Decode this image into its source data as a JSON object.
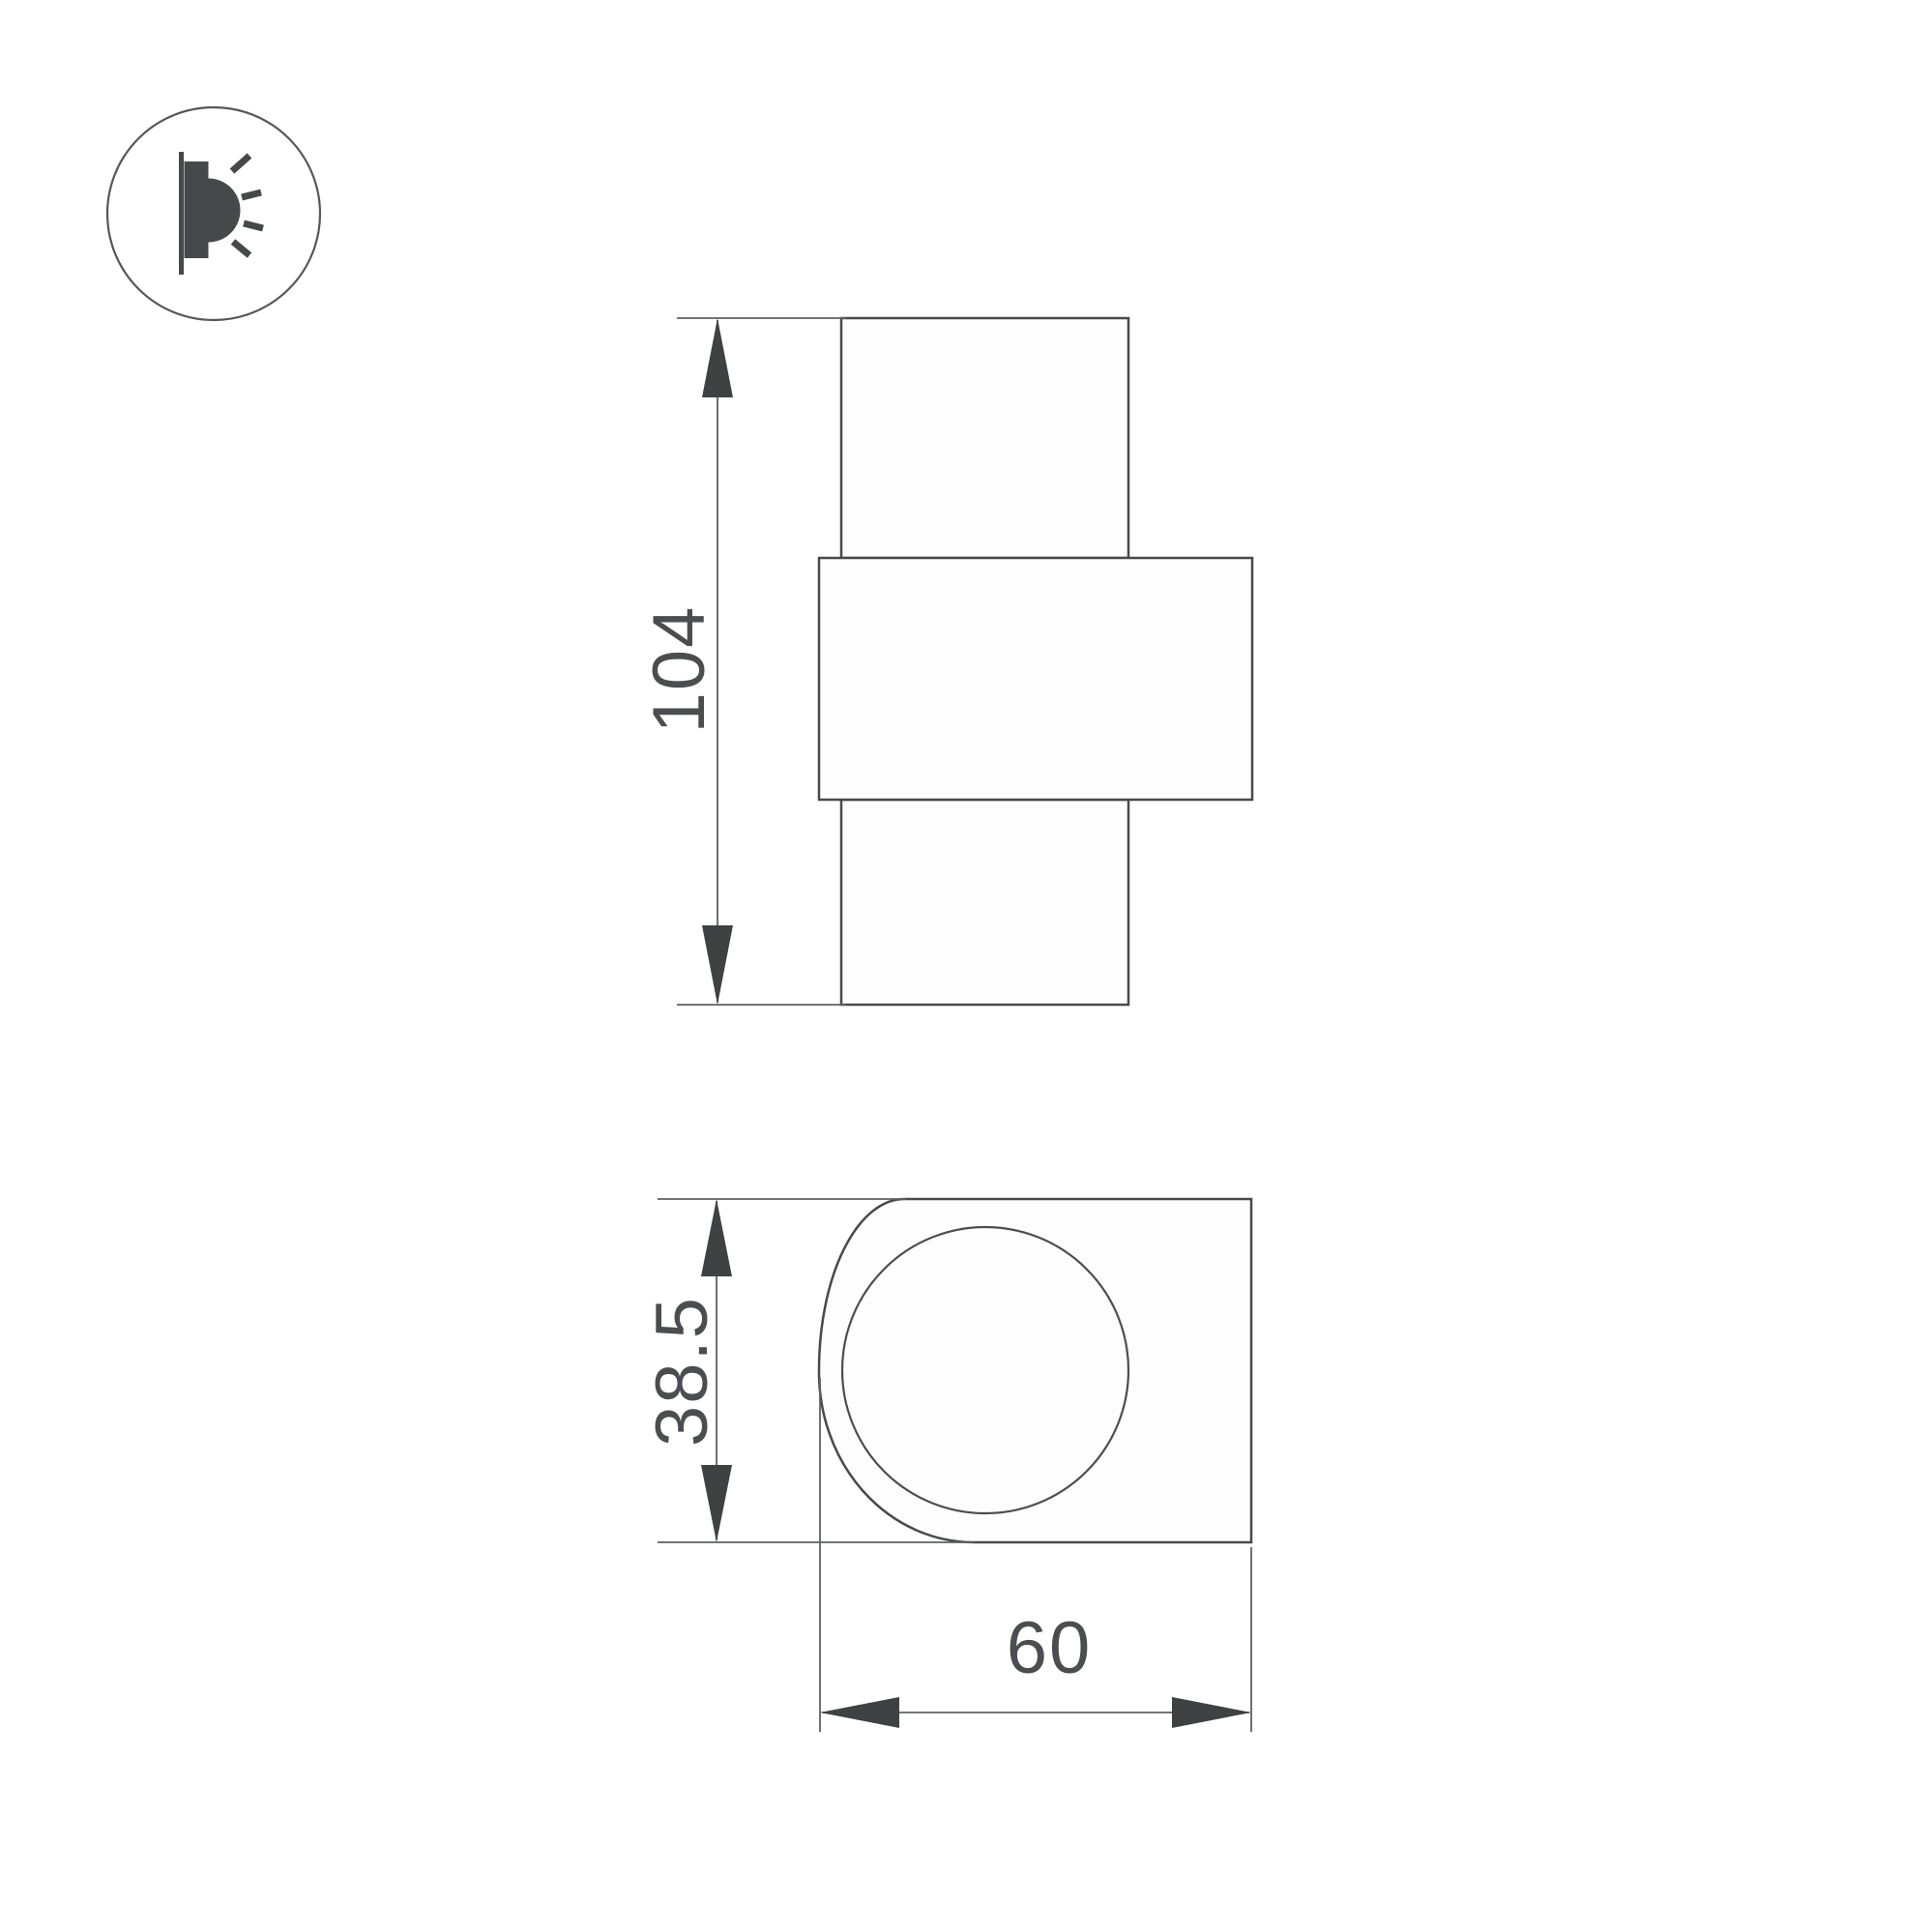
{
  "drawing": {
    "dimension_labels": {
      "height": "104",
      "depth": "38.5",
      "width": "60"
    },
    "icon": {
      "name": "wall-light-icon",
      "description": "wall-mounted-luminaire-side-emission"
    },
    "colors": {
      "background": "#ffffff",
      "shape_outline": "#48494b",
      "shape_fill": "#fdfdfd",
      "dimension_line": "#5e6062",
      "arrow": "#3f4143",
      "label_text": "#4b4d50",
      "icon_glyph": "#46484a"
    }
  }
}
